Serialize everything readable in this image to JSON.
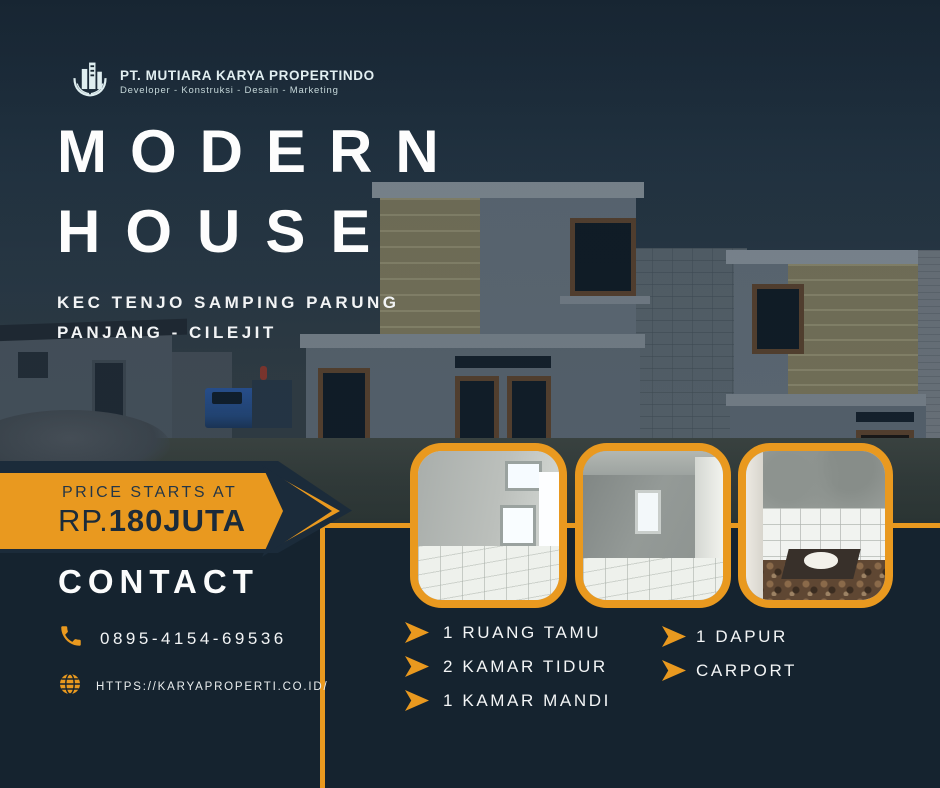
{
  "brand": {
    "company": "PT. MUTIARA KARYA PROPERTINDO",
    "tagline": "Developer - Konstruksi - Desain - Marketing"
  },
  "hero": {
    "title_line1": "MODERN",
    "title_line2": "HOUSE",
    "location_line1": "KEC TENJO SAMPING PARUNG",
    "location_line2": "PANJANG - CILEJIT"
  },
  "price": {
    "label": "PRICE STARTS AT",
    "prefix": "RP.",
    "amount": "180JUTA"
  },
  "contact": {
    "heading": "CONTACT",
    "phone": "0895-4154-69536",
    "website": "HTTPS://KARYAPROPERTI.CO.ID/"
  },
  "features": {
    "left": [
      {
        "label": "1 RUANG TAMU"
      },
      {
        "label": "2 KAMAR TIDUR"
      },
      {
        "label": "1 KAMAR MANDI"
      }
    ],
    "right": [
      {
        "label": "1 DAPUR"
      },
      {
        "label": "CARPORT"
      }
    ]
  },
  "photos": [
    {
      "name": "living-room-photo"
    },
    {
      "name": "bedroom-photo"
    },
    {
      "name": "bathroom-photo"
    }
  ],
  "icons": {
    "logo": "building-with-laurel-icon",
    "phone": "phone-icon",
    "website": "globe-icon",
    "bullet": "arrow-right-bullet"
  },
  "colors": {
    "orange": "#E9991F",
    "navy": "#15232F",
    "banner_navy": "#1B2B3A",
    "white": "#FFFFFF"
  }
}
